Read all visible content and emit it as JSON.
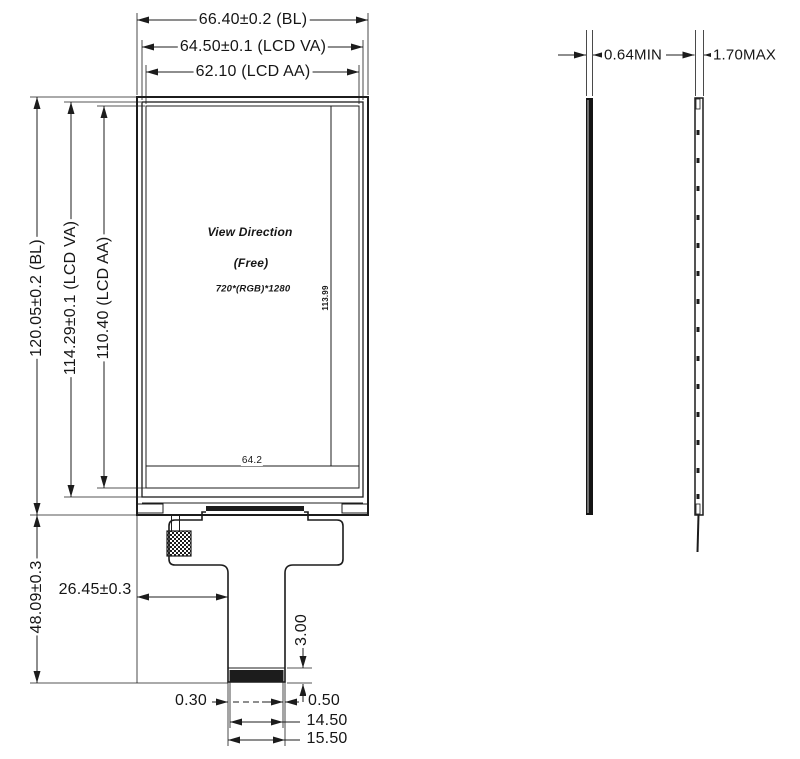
{
  "front": {
    "dim_bl_width": "66.40±0.2 (BL)",
    "dim_va_width": "64.50±0.1 (LCD VA)",
    "dim_aa_width": "62.10 (LCD AA)",
    "dim_bl_height": "120.05±0.2 (BL)",
    "dim_va_height": "114.29±0.1 (LCD VA)",
    "dim_aa_height": "110.40 (LCD AA)",
    "view_direction": "View Direction",
    "view_mode": "(Free)",
    "resolution": "720*(RGB)*1280",
    "dim_internal_height": "113.99",
    "dim_bottom_ledge": "64.2",
    "dim_module_height": "48.09±0.3",
    "dim_fpc_offset": "26.45±0.3",
    "dim_stiffener_height": "3.00",
    "dim_tail_left_margin": "0.30",
    "dim_tail_right_margin": "0.50",
    "dim_contact_width": "14.50",
    "dim_tail_width": "15.50"
  },
  "side": {
    "dim_lcd_thickness": "0.64MIN",
    "dim_module_thickness": "1.70MAX"
  },
  "colors": {
    "line": "#1c1c1c",
    "background": "#ffffff"
  }
}
